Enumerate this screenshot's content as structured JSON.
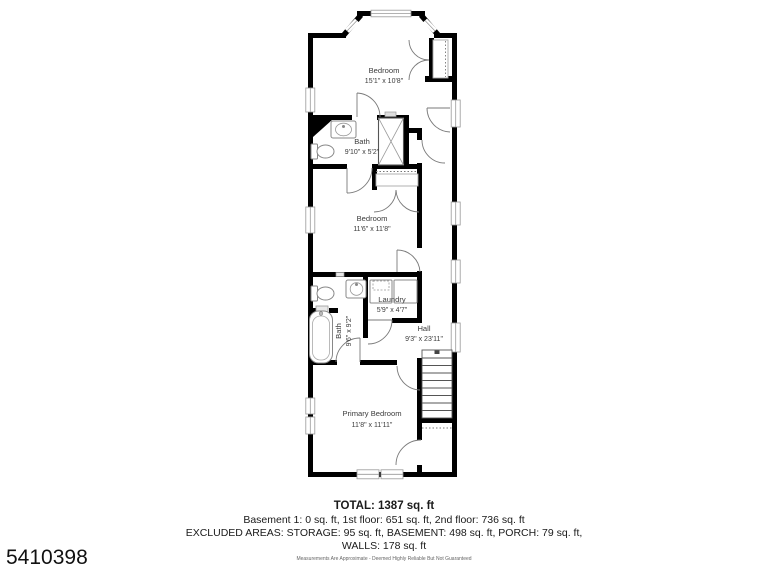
{
  "listing_id": "5410398",
  "floor_plan": {
    "rooms": {
      "bedroom_top": {
        "name": "Bedroom",
        "dims": "15'1\" x 10'8\""
      },
      "bath_top": {
        "name": "Bath",
        "dims": "9'10\" x 5'2\""
      },
      "bedroom_middle": {
        "name": "Bedroom",
        "dims": "11'6\" x 11'8\""
      },
      "laundry": {
        "name": "Laundry",
        "dims": "5'9\" x 4'7\""
      },
      "bath_lower": {
        "name": "Bath",
        "dims": "9'6\" x 9'2\""
      },
      "hall": {
        "name": "Hall",
        "dims": "9'3\" x 23'11\""
      },
      "primary_bedroom": {
        "name": "Primary Bedroom",
        "dims": "11'8\" x 11'11\""
      }
    }
  },
  "summary": {
    "total": "TOTAL: 1387 sq. ft",
    "floors_line": "Basement 1: 0 sq. ft, 1st floor: 651 sq. ft, 2nd floor: 736 sq. ft",
    "excluded_line": "EXCLUDED AREAS: STORAGE: 95 sq. ft, BASEMENT: 498 sq. ft, PORCH: 79 sq. ft,",
    "walls_line": "WALLS: 178 sq. ft",
    "disclaimer": "Measurements Are Approximate - Deemed Highly Reliable But Not Guaranteed"
  },
  "colors": {
    "walls": "#000000",
    "background": "#ffffff",
    "fixtures": "#888888",
    "text": "#3c3c3c"
  }
}
